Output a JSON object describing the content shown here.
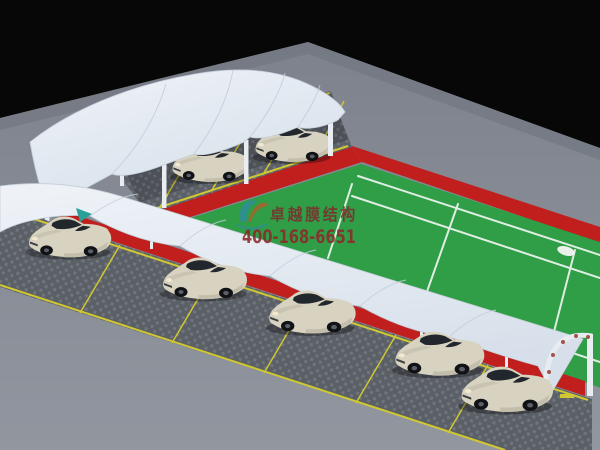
{
  "image": {
    "type": "3d-architectural-render",
    "subject": "Membrane-structure carports with parked cars beside a red-bordered green tennis court on a gray ground plane",
    "background": "#070707"
  },
  "watermark": {
    "brand_text": "卓越膜结构",
    "phone_text": "400-168-6651",
    "brand_color": "#7c2d2d",
    "phone_color": "#8c2b2b",
    "logo_teal": "#2f8d95",
    "logo_orange": "#a9622a"
  },
  "scene": {
    "colors": {
      "sky": "#070707",
      "ground": "#91969f",
      "ground_far": "#7d828c",
      "court_green": "#2f9e47",
      "court_red": "#c11f1e",
      "court_line": "#f0f4f0",
      "membrane": "#eff3f8",
      "membrane_shade": "#d7e0ea",
      "paving": "#5b6067",
      "paving_dot": "#70757d",
      "parking_line": "#cfc832",
      "car_body": "#d7d3c0",
      "car_body_shade": "#c2beab",
      "car_glass": "#22262d",
      "steel": "#e9edf1",
      "teal_accent": "#2aa198",
      "arch_dot": "#a05348"
    },
    "counts": {
      "upper_row_cars": 4,
      "lower_row_cars": 5
    }
  }
}
